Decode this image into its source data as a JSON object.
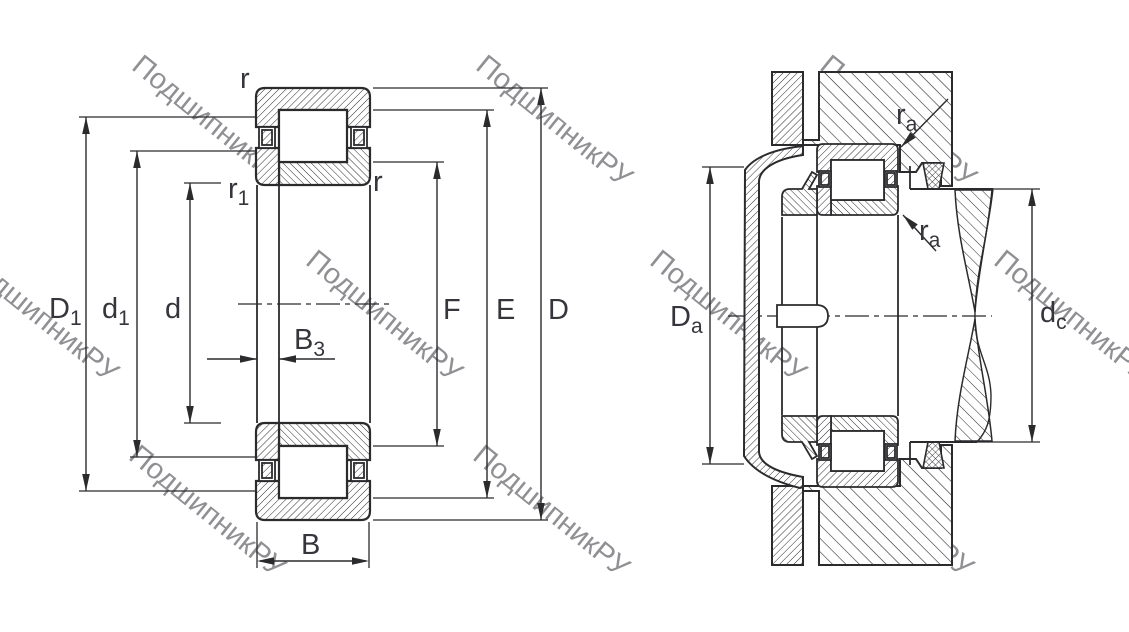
{
  "drawing": {
    "type": "bearing-technical-drawing",
    "views": [
      "cross-section",
      "mounted-arrangement"
    ]
  },
  "colors": {
    "line": "#2b2b2e",
    "label": "#35353c",
    "watermark": "#bdbdbd",
    "background": "#ffffff"
  },
  "watermark": {
    "text": "ПодшипникРУ",
    "angle_deg": 39,
    "opacity": 0.55
  },
  "labels": {
    "r_outer": "r",
    "r_inner": "r",
    "r1": {
      "m": "r",
      "s": "1"
    },
    "D1": {
      "m": "D",
      "s": "1"
    },
    "d1": {
      "m": "d",
      "s": "1"
    },
    "d": "d",
    "B3": {
      "m": "B",
      "s": "3"
    },
    "B": "B",
    "F": "F",
    "E": "E",
    "D": "D",
    "ra_upper": {
      "m": "r",
      "s": "a"
    },
    "ra_lower": {
      "m": "r",
      "s": "a"
    },
    "Da": {
      "m": "D",
      "s": "a"
    },
    "dc": {
      "m": "d",
      "s": "c"
    }
  }
}
